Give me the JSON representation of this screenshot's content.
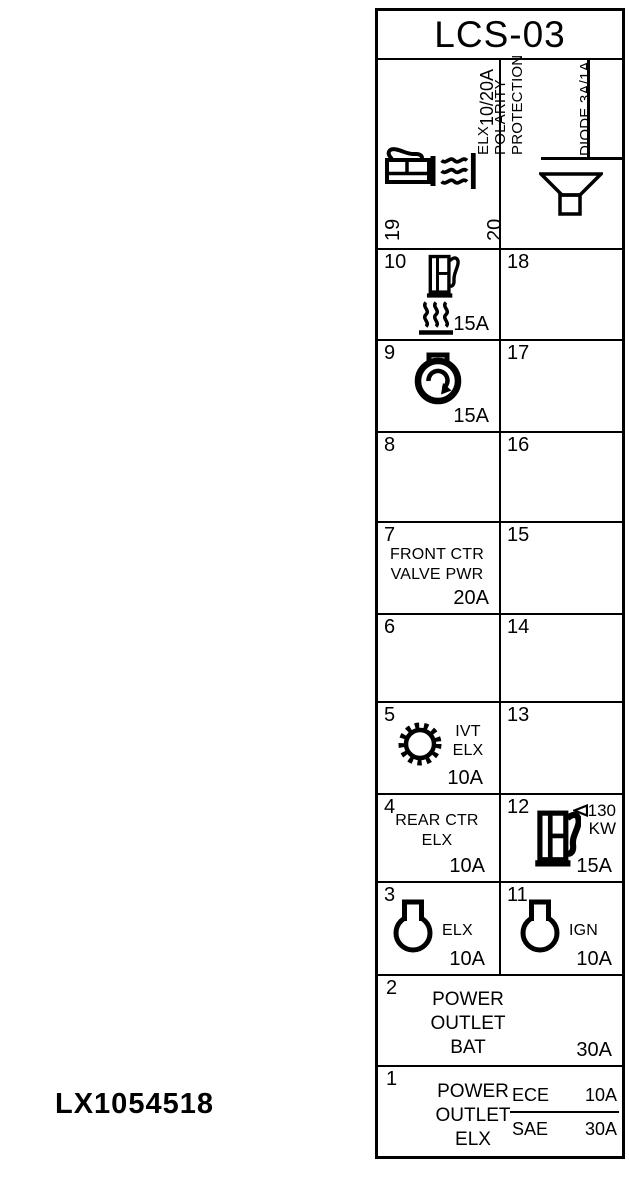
{
  "colors": {
    "ink": "#000000",
    "bg": "#ffffff"
  },
  "figure_label": "LX1054518",
  "panel": {
    "title": "LCS-03",
    "fuses": {
      "f1": {
        "number": "1",
        "line1": "POWER",
        "line2": "OUTLET",
        "line3": "ELX",
        "ece_label": "ECE",
        "ece_amps": "10A",
        "sae_label": "SAE",
        "sae_amps": "30A"
      },
      "f2": {
        "number": "2",
        "line1": "POWER",
        "line2": "OUTLET",
        "line3": "BAT",
        "amps": "30A"
      },
      "f3": {
        "number": "3",
        "label": "ELX",
        "amps": "10A"
      },
      "f4": {
        "number": "4",
        "line1": "REAR CTR",
        "line2": "ELX",
        "amps": "10A"
      },
      "f5": {
        "number": "5",
        "line1": "IVT",
        "line2": "ELX",
        "amps": "10A"
      },
      "f6": {
        "number": "6"
      },
      "f7": {
        "number": "7",
        "line1": "FRONT CTR",
        "line2": "VALVE PWR",
        "amps": "20A"
      },
      "f8": {
        "number": "8"
      },
      "f9": {
        "number": "9",
        "amps": "15A"
      },
      "f10": {
        "number": "10",
        "amps": "15A"
      },
      "f11": {
        "number": "11",
        "label": "IGN",
        "amps": "10A"
      },
      "f12": {
        "number": "12",
        "kw_value": "130",
        "kw_unit": "KW",
        "amps": "15A"
      },
      "f13": {
        "number": "13"
      },
      "f14": {
        "number": "14"
      },
      "f15": {
        "number": "15"
      },
      "f16": {
        "number": "16"
      },
      "f17": {
        "number": "17"
      },
      "f18": {
        "number": "18"
      },
      "f19": {
        "number": "19",
        "amps": "10/20A"
      },
      "f20": {
        "number": "20",
        "label_line1": "ELX",
        "label_line2": "POLARITY",
        "label_line3": "PROTECTION",
        "diode_label": "DIODE 3A/1A"
      }
    },
    "icons": {
      "f19": [
        "fuel-pump-icon",
        "heat-waves-icon"
      ],
      "f20": [
        "speaker-horn-icon"
      ],
      "f10": [
        "fuel-pump-icon",
        "heat-waves-icon"
      ],
      "f9": [
        "fuel-cap-rotate-icon"
      ],
      "f5": [
        "gear-ring-icon"
      ],
      "f12": [
        "fuel-pump-icon",
        "limit-arrow-icon"
      ],
      "f3": [
        "socket-bulb-icon"
      ],
      "f11": [
        "socket-bulb-icon"
      ]
    }
  }
}
